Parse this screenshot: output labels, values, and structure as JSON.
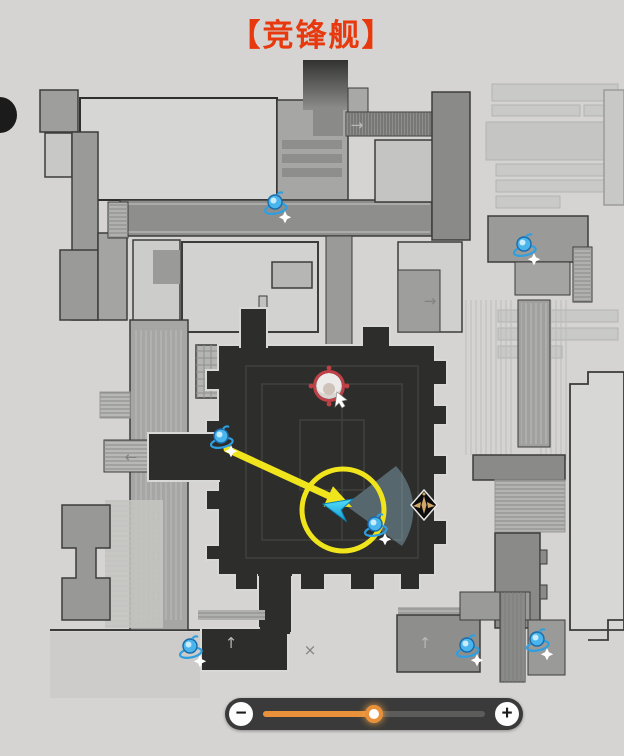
{
  "title": {
    "text": "【竞锋舰】",
    "color": "#e8380d"
  },
  "map": {
    "name": "竞锋舰",
    "markers": {
      "enemies": [
        {
          "x": 275,
          "y": 205
        },
        {
          "x": 524,
          "y": 247
        },
        {
          "x": 221,
          "y": 439
        },
        {
          "x": 375,
          "y": 527
        },
        {
          "x": 190,
          "y": 649
        },
        {
          "x": 467,
          "y": 648
        },
        {
          "x": 537,
          "y": 642
        }
      ],
      "player": {
        "x": 329,
        "y": 386
      },
      "elite": {
        "x": 424,
        "y": 505
      },
      "view_direction": {
        "x": 342,
        "y": 507
      }
    },
    "annotations": {
      "highlight_circle": {
        "cx": 343,
        "cy": 510,
        "r": 41,
        "color": "#f0e41c"
      },
      "guide_arrow": {
        "x1": 227,
        "y1": 449,
        "x2": 329,
        "y2": 496,
        "head_points": "352,507 323.5,506.5 333,486.3",
        "color": "#f0e41c"
      }
    },
    "direction_arrows": [
      {
        "x": 357,
        "y": 130,
        "glyph": "→",
        "on_dark": true
      },
      {
        "x": 430,
        "y": 306,
        "glyph": "→",
        "on_dark": false
      },
      {
        "x": 131,
        "y": 462,
        "glyph": "←",
        "on_dark": false
      },
      {
        "x": 231,
        "y": 648,
        "glyph": "↑",
        "on_dark": true
      },
      {
        "x": 425,
        "y": 648,
        "glyph": "↑",
        "on_dark": true
      },
      {
        "x": 310,
        "y": 655,
        "glyph": "×",
        "on_dark": false
      }
    ]
  },
  "zoom_control": {
    "minus_label": "−",
    "plus_label": "+",
    "value_percent": 50,
    "track_color": "#e8913a"
  }
}
